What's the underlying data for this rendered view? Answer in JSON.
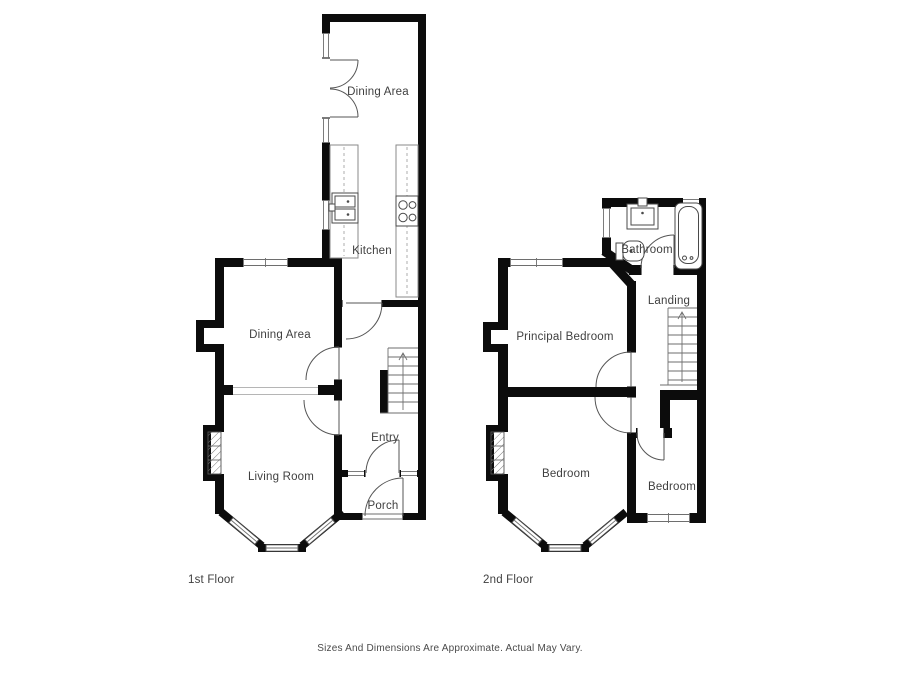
{
  "page": {
    "background": "#ffffff",
    "wall_color": "#0c0c0c",
    "label_color": "#3f3f3f"
  },
  "floor1": {
    "title": "1st Floor",
    "rooms": {
      "wing_dining": "Dining Area",
      "kitchen": "Kitchen",
      "dining": "Dining Area",
      "living": "Living Room",
      "entry": "Entry",
      "porch": "Porch"
    }
  },
  "floor2": {
    "title": "2nd Floor",
    "rooms": {
      "bathroom": "Bathroom",
      "landing": "Landing",
      "principal": "Principal Bedroom",
      "bedroom_mid": "Bedroom",
      "bedroom_small": "Bedroom"
    }
  },
  "footer": {
    "disclaimer": "Sizes And Dimensions Are Approximate. Actual May Vary."
  }
}
